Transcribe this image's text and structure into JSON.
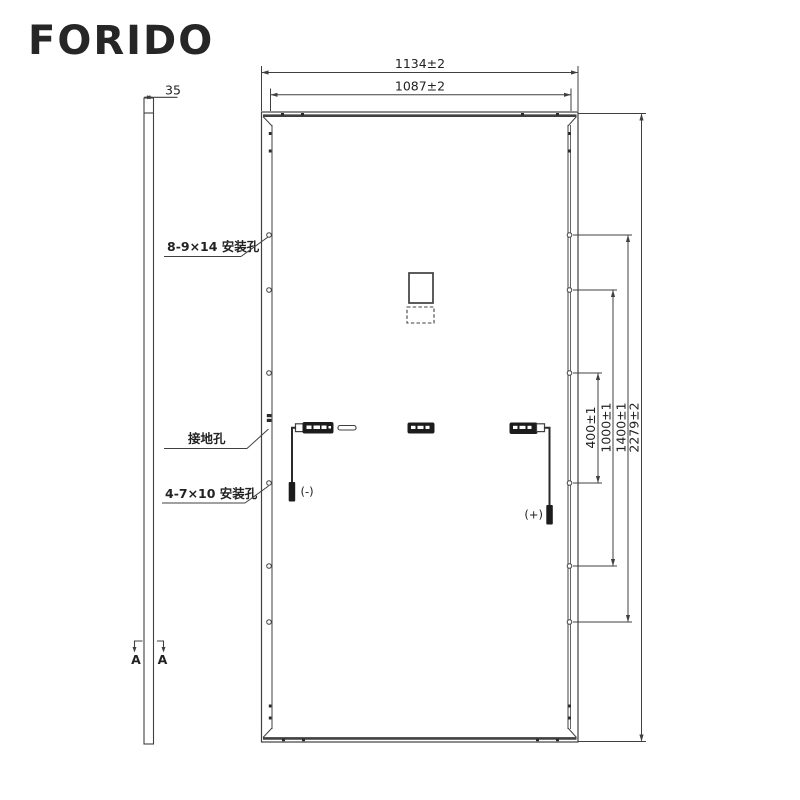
{
  "brand": {
    "logo": "FORIDO"
  },
  "side_view": {
    "thickness_dim": "35",
    "section_label_left": "A",
    "section_label_right": "A"
  },
  "rear_view": {
    "dimensions": {
      "outer_width": "1134±2",
      "inner_width": "1087±2",
      "height": "2279±2",
      "hole_span_large": "1400±1",
      "hole_span_mid": "1000±1",
      "hole_span_small": "400±1"
    },
    "callouts": {
      "mounting_holes_large": "8-9×14 安装孔",
      "grounding_hole": "接地孔",
      "mounting_holes_small": "4-7×10 安装孔"
    },
    "connectors": {
      "negative": "(-)",
      "positive": "(+)"
    }
  },
  "colors": {
    "line": "#404040",
    "text": "#222222",
    "logo": "#262626",
    "background": "#ffffff",
    "box_fill": "#1c1c1c"
  }
}
